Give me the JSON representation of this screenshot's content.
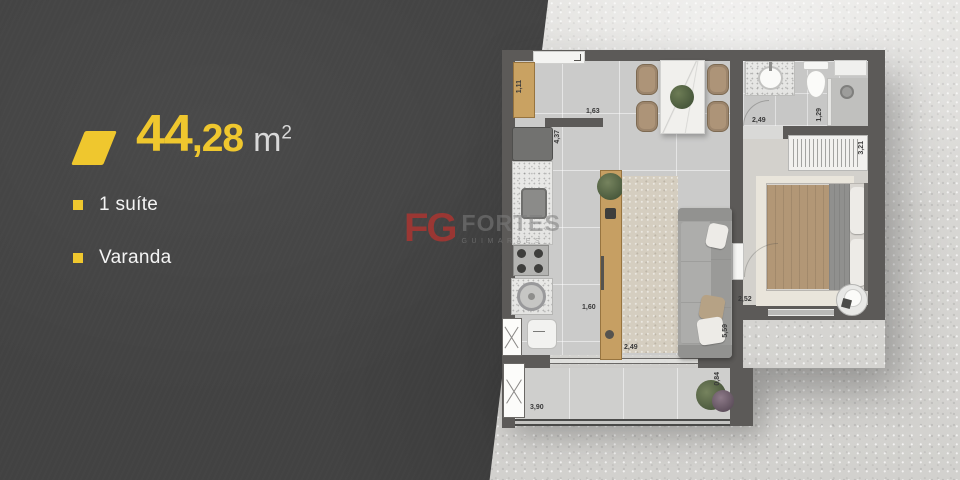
{
  "colors": {
    "accent_yellow": "#efc72e",
    "dark_background": "#424242",
    "light_background": "#d8d7d4",
    "wall_gray": "#5c5a58",
    "watermark_red": "#a93531"
  },
  "info_panel": {
    "area": {
      "whole": "44",
      "separator": ",",
      "decimal": "28",
      "unit": "m",
      "exponent": "2"
    },
    "features": [
      {
        "label": "1 suíte"
      },
      {
        "label": "Varanda"
      }
    ]
  },
  "watermark": {
    "initials": "FG",
    "name": "FORTES",
    "subname": "GUIMARÃES"
  },
  "floorplan": {
    "dimensions": {
      "entry_counter": "1,11",
      "entry_wall": "1,63",
      "kitchen_run": "4,37",
      "kitchen_aisle": "1,60",
      "living_width": "2,49",
      "living_length": "5,59",
      "balcony_length": "3,90",
      "balcony_depth": "0,84",
      "bathroom_width": "2,49",
      "bathroom_depth": "1,29",
      "bedroom_length": "3,21",
      "bedroom_width": "2,52"
    }
  }
}
